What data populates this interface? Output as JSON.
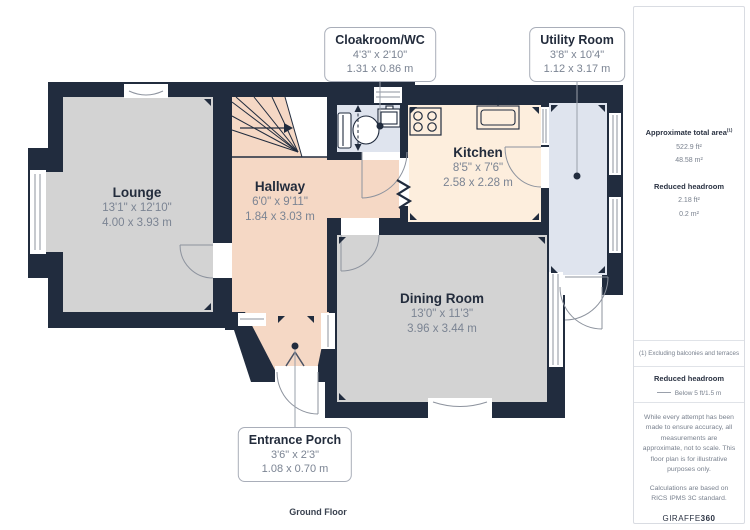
{
  "plan": {
    "floor_label": "Ground Floor",
    "rooms": [
      {
        "name": "Lounge",
        "imperial": "13'1\" x 12'10\"",
        "metric": "4.00 x 3.93 m"
      },
      {
        "name": "Hallway",
        "imperial": "6'0\" x 9'11\"",
        "metric": "1.84 x 3.03 m"
      },
      {
        "name": "Kitchen",
        "imperial": "8'5\" x 7'6\"",
        "metric": "2.58 x 2.28 m"
      },
      {
        "name": "Dining Room",
        "imperial": "13'0\" x 11'3\"",
        "metric": "3.96 x 3.44 m"
      }
    ],
    "callouts": [
      {
        "name": "Cloakroom/WC",
        "imperial": "4'3\" x 2'10\"",
        "metric": "1.31 x 0.86 m"
      },
      {
        "name": "Utility Room",
        "imperial": "3'8\" x 10'4\"",
        "metric": "1.12 x 3.17 m"
      },
      {
        "name": "Entrance Porch",
        "imperial": "3'6\" x 2'3\"",
        "metric": "1.08 x 0.70 m"
      }
    ]
  },
  "sidebar": {
    "total_area": {
      "label": "Approximate total area",
      "superscript": "(1)",
      "ft": "522.9 ft²",
      "m": "48.58 m²"
    },
    "reduced_headroom": {
      "label": "Reduced headroom",
      "ft": "2.18 ft²",
      "m": "0.2 m²"
    },
    "footnote": "(1) Excluding balconies and terraces",
    "legend": {
      "title": "Reduced headroom",
      "item": "Below 5 ft/1.5 m"
    },
    "disclaimer": "While every attempt has been made to ensure accuracy, all measurements are approximate, not to scale. This floor plan is for illustrative purposes only.",
    "standard": "Calculations are based on RICS IPMS 3C standard.",
    "brand": {
      "regular": "GIRAFFE",
      "bold": "360"
    }
  },
  "colors": {
    "wall": "#212c3e",
    "lounge_floor": "#d3d3d3",
    "dining_floor": "#d3d3d3",
    "hallway_floor": "#f5d8c5",
    "kitchen_floor": "#fdeedd",
    "wet_room_floor": "#dfe4ee",
    "door_stroke": "#8d939e",
    "label_title": "#232c3c",
    "label_dims": "#7b8493"
  }
}
